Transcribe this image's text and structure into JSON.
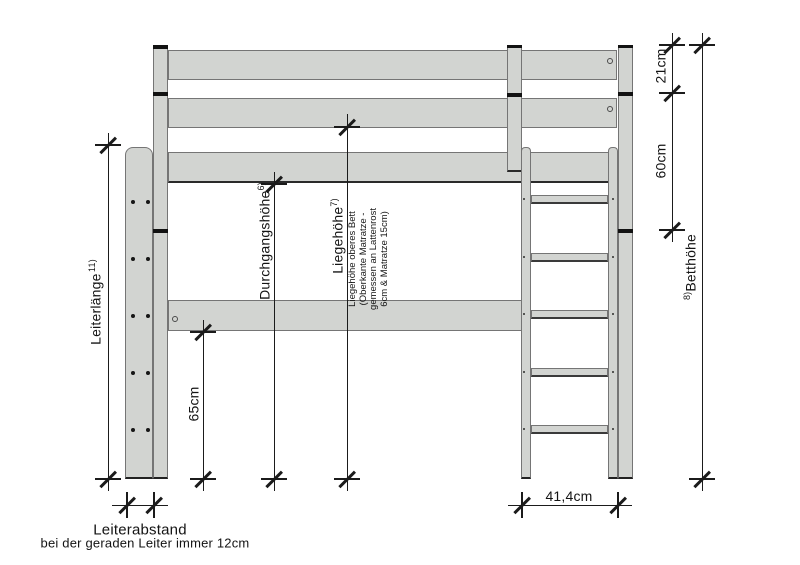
{
  "drawing": {
    "type": "technical-drawing",
    "subject": "loft bed side elevation with ladder",
    "colors": {
      "wood_fill": "#d2d4d1",
      "wood_outline": "#757575",
      "dimension_line": "#1b1b1b",
      "joint_black": "#121212",
      "background": "#ffffff"
    }
  },
  "dimensions": {
    "d21": "21cm",
    "d60": "60cm",
    "d65": "65cm",
    "d414": "41,4cm",
    "betthoehe": {
      "sup": "8)",
      "text": "Betthöhe"
    },
    "leiterlaenge": {
      "text": "Leiterlänge",
      "sup": "11)"
    },
    "durchgangshoehe": {
      "text": "Durchgangshöhe",
      "sup": "6)"
    },
    "liegehoehe": {
      "text": "Liegehöhe",
      "sup": "7)"
    },
    "liegehoehe_note": {
      "lines": [
        "Liegehöhe oberes Bett",
        "(Oberkante Matratze -",
        "gemessen an Lattenrost",
        "6cm & Matratze 15cm)"
      ]
    },
    "leiterabstand": {
      "title": "Leiterabstand",
      "subtitle": "bei der geraden Leiter immer 12cm"
    }
  }
}
